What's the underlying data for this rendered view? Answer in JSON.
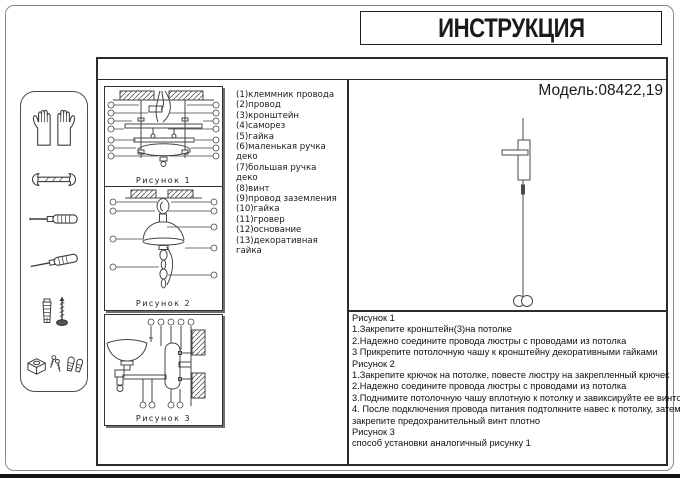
{
  "header": {
    "title": "ИНСТРУКЦИЯ",
    "model": "Модель:08422,19"
  },
  "tools": {
    "items": [
      {
        "name": "gloves"
      },
      {
        "name": "wrench"
      },
      {
        "name": "flat-screwdriver"
      },
      {
        "name": "phillips-screwdriver"
      },
      {
        "name": "wall-anchor-and-screw"
      },
      {
        "name": "small-fasteners"
      }
    ]
  },
  "figures": [
    {
      "caption": "Рисунок 1"
    },
    {
      "caption": "Рисунок 2"
    },
    {
      "caption": "Рисунок  3"
    }
  ],
  "parts": [
    "(1)клеммник провода",
    "(2)провод",
    "(3)кронштейн",
    "(4)саморез",
    "(5)гайка",
    "(6)маленькая ручка деко",
    "(7)большая ручка деко",
    "(8)винт",
    "(9)провод заземления",
    "(10)гайка",
    "(11)гровер",
    "(12)основание",
    "(13)декоративная гайка"
  ],
  "instructions": [
    "Рисунок 1",
    "1.Закрепите кронштейн(3)на потолке",
    "2.Надежно соедините провода люстры с проводами из потолка",
    "3 Прикрепите потолочную чашу к кронштейну декоративными гайками",
    "Рисунок 2",
    "1.Закрепите крючок на потолке, повесте люстру на закрепленный крючек",
    "2.Надежно соедините провода люстры с проводами из потолка",
    "3.Поднимите потолочную чашу вплотную к потолку и завиксируйте ее винтом",
    "4. После подключения провода питания подтолкните навес к потолку, затем",
    "закрепите предохранительный винт плотно",
    "Рисунок 3",
    " способ установки аналогичный рисунку 1"
  ]
}
